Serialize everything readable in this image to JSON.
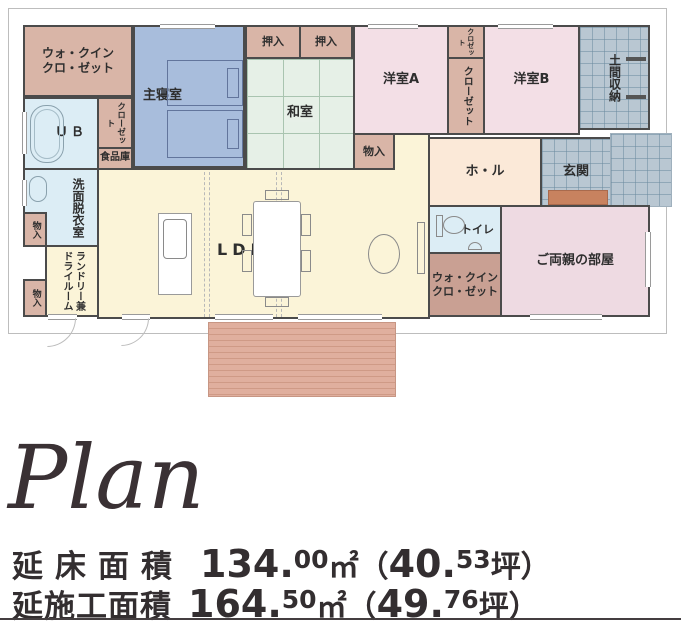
{
  "rooms": {
    "wic1": {
      "line1": "ウォ・クイン",
      "line2": "クロ・ゼット"
    },
    "master": {
      "label": "主寝室"
    },
    "oshiire1": {
      "label": "押入"
    },
    "oshiire2": {
      "label": "押入"
    },
    "washitsu": {
      "label": "和室"
    },
    "yoshitsuA": {
      "label": "洋室A"
    },
    "closetTop": {
      "label": "クロゼット"
    },
    "closetMid": {
      "label": "クローゼット"
    },
    "yoshitsuB": {
      "label": "洋室B"
    },
    "doma": {
      "label": "土間収納"
    },
    "ub": {
      "label": "ＵＢ"
    },
    "closetUb": {
      "label": "クローゼット"
    },
    "pantry": {
      "label": "食品庫"
    },
    "senmen": {
      "label": "洗面脱衣室"
    },
    "mono1": {
      "label": "物入"
    },
    "mono2": {
      "label": "物入"
    },
    "mono3": {
      "label": "物入"
    },
    "laundry": {
      "line1": "ランドリー兼",
      "line2": "ドライルーム"
    },
    "ldk": {
      "label": "LDK"
    },
    "hall": {
      "label": "ホ・ル"
    },
    "genkan": {
      "label": "玄関"
    },
    "toilet": {
      "label": "トイレ"
    },
    "wic2": {
      "line1": "ウォ・クイン",
      "line2": "クロ・ゼット"
    },
    "parents": {
      "label": "ご両親の部屋"
    }
  },
  "footer": {
    "title": "Plan",
    "line1": {
      "label": "延床面積",
      "n1": "134.",
      "s1": "00",
      "u1": "㎡（",
      "n2": "40.",
      "s2": "53",
      "u2": "坪）"
    },
    "line2": {
      "label": "延施工面積",
      "n1": "164.",
      "s1": "50",
      "u1": "㎡（",
      "n2": "49.",
      "s2": "76",
      "u2": "坪）"
    }
  },
  "colors": {
    "wall": "#4b4b4b",
    "closet_fill": "#d9b5a7",
    "closet_dark_fill": "#c9a093",
    "master_bedroom_fill": "#a8bddc",
    "tatami_fill": "#e6f0e7",
    "western_room_fill": "#f3dfe6",
    "hall_fill": "#fbe9d8",
    "bath_fill": "#dcedf5",
    "ldk_fill": "#fbf4d8",
    "entrance_fill": "#b9c7d2",
    "deck_fill": "#e0af9e",
    "entrance_step_fill": "#c8825f",
    "text": "#2b2b2b"
  }
}
